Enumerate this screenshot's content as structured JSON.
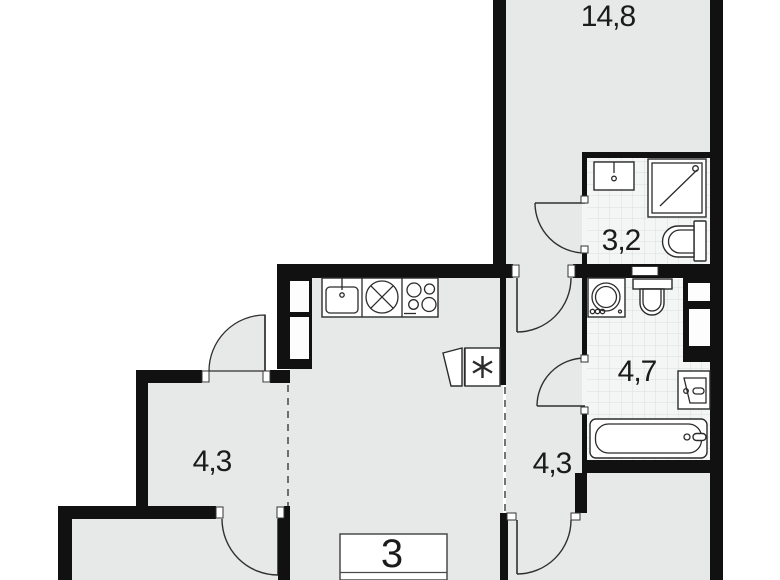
{
  "floorplan": {
    "type": "apartment-floor-plan",
    "apartment_number": "3",
    "rooms": [
      {
        "id": "living-room",
        "area": "14,8"
      },
      {
        "id": "bathroom-small",
        "area": "3,2"
      },
      {
        "id": "bathroom-large",
        "area": "4,7"
      },
      {
        "id": "storage-room",
        "area": "4,3"
      },
      {
        "id": "hallway",
        "area": "4,3"
      }
    ],
    "fixtures": {
      "bathroom_small": [
        "washbasin",
        "shower-cabin",
        "toilet"
      ],
      "bathroom_large": [
        "washing-machine",
        "toilet",
        "ventilation-shaft",
        "washbasin",
        "bathtub"
      ],
      "kitchen": [
        "kitchen-sink",
        "round-hob",
        "stove-4-burner",
        "vent-duct",
        "tall-cabinet"
      ]
    },
    "colors": {
      "wall": "#111111",
      "floor": "#e7e9e9",
      "tile_background": "#f4f6f6",
      "tile_grid": "#d9dddd",
      "fixture_outline": "#2b2b2b",
      "label_text": "#1b1b1b",
      "background": "#ffffff"
    }
  }
}
